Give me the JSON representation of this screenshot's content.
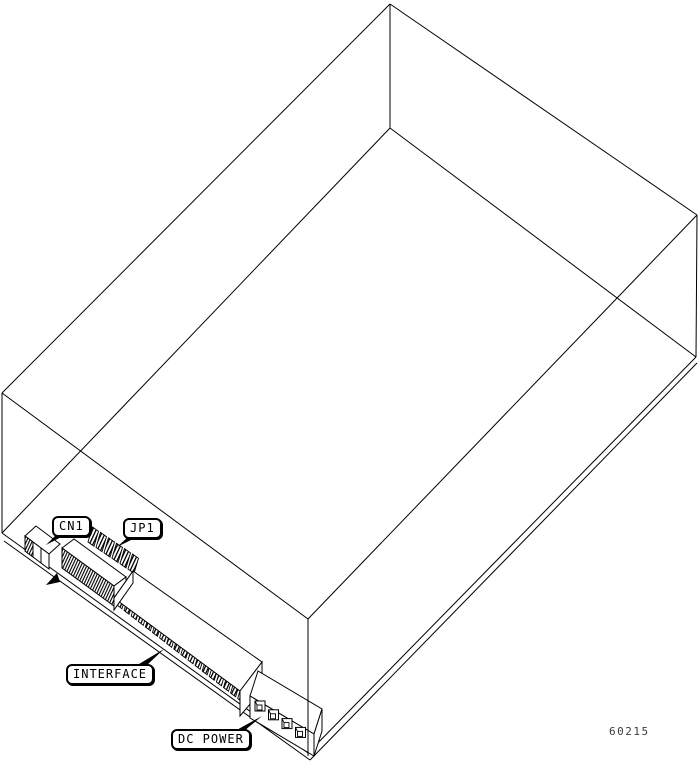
{
  "figure": {
    "drawing_number": "60215",
    "line_color": "#000000",
    "background_color": "#ffffff",
    "subject": "disk-drive-isometric-rear-view"
  },
  "callouts": {
    "cn1": {
      "label": "CN1"
    },
    "jp1": {
      "label": "JP1"
    },
    "interface": {
      "label": "INTERFACE"
    },
    "dc_power": {
      "label": "DC POWER"
    }
  },
  "components": {
    "chassis": "drive-chassis-wireframe",
    "cn1": "cn1-connector",
    "jp1": "jp1-jumper-header",
    "interface": "interface-edge-connector",
    "dc_power": "dc-power-4pin-connector",
    "pin_marker": "pin1-arrow-marker"
  }
}
